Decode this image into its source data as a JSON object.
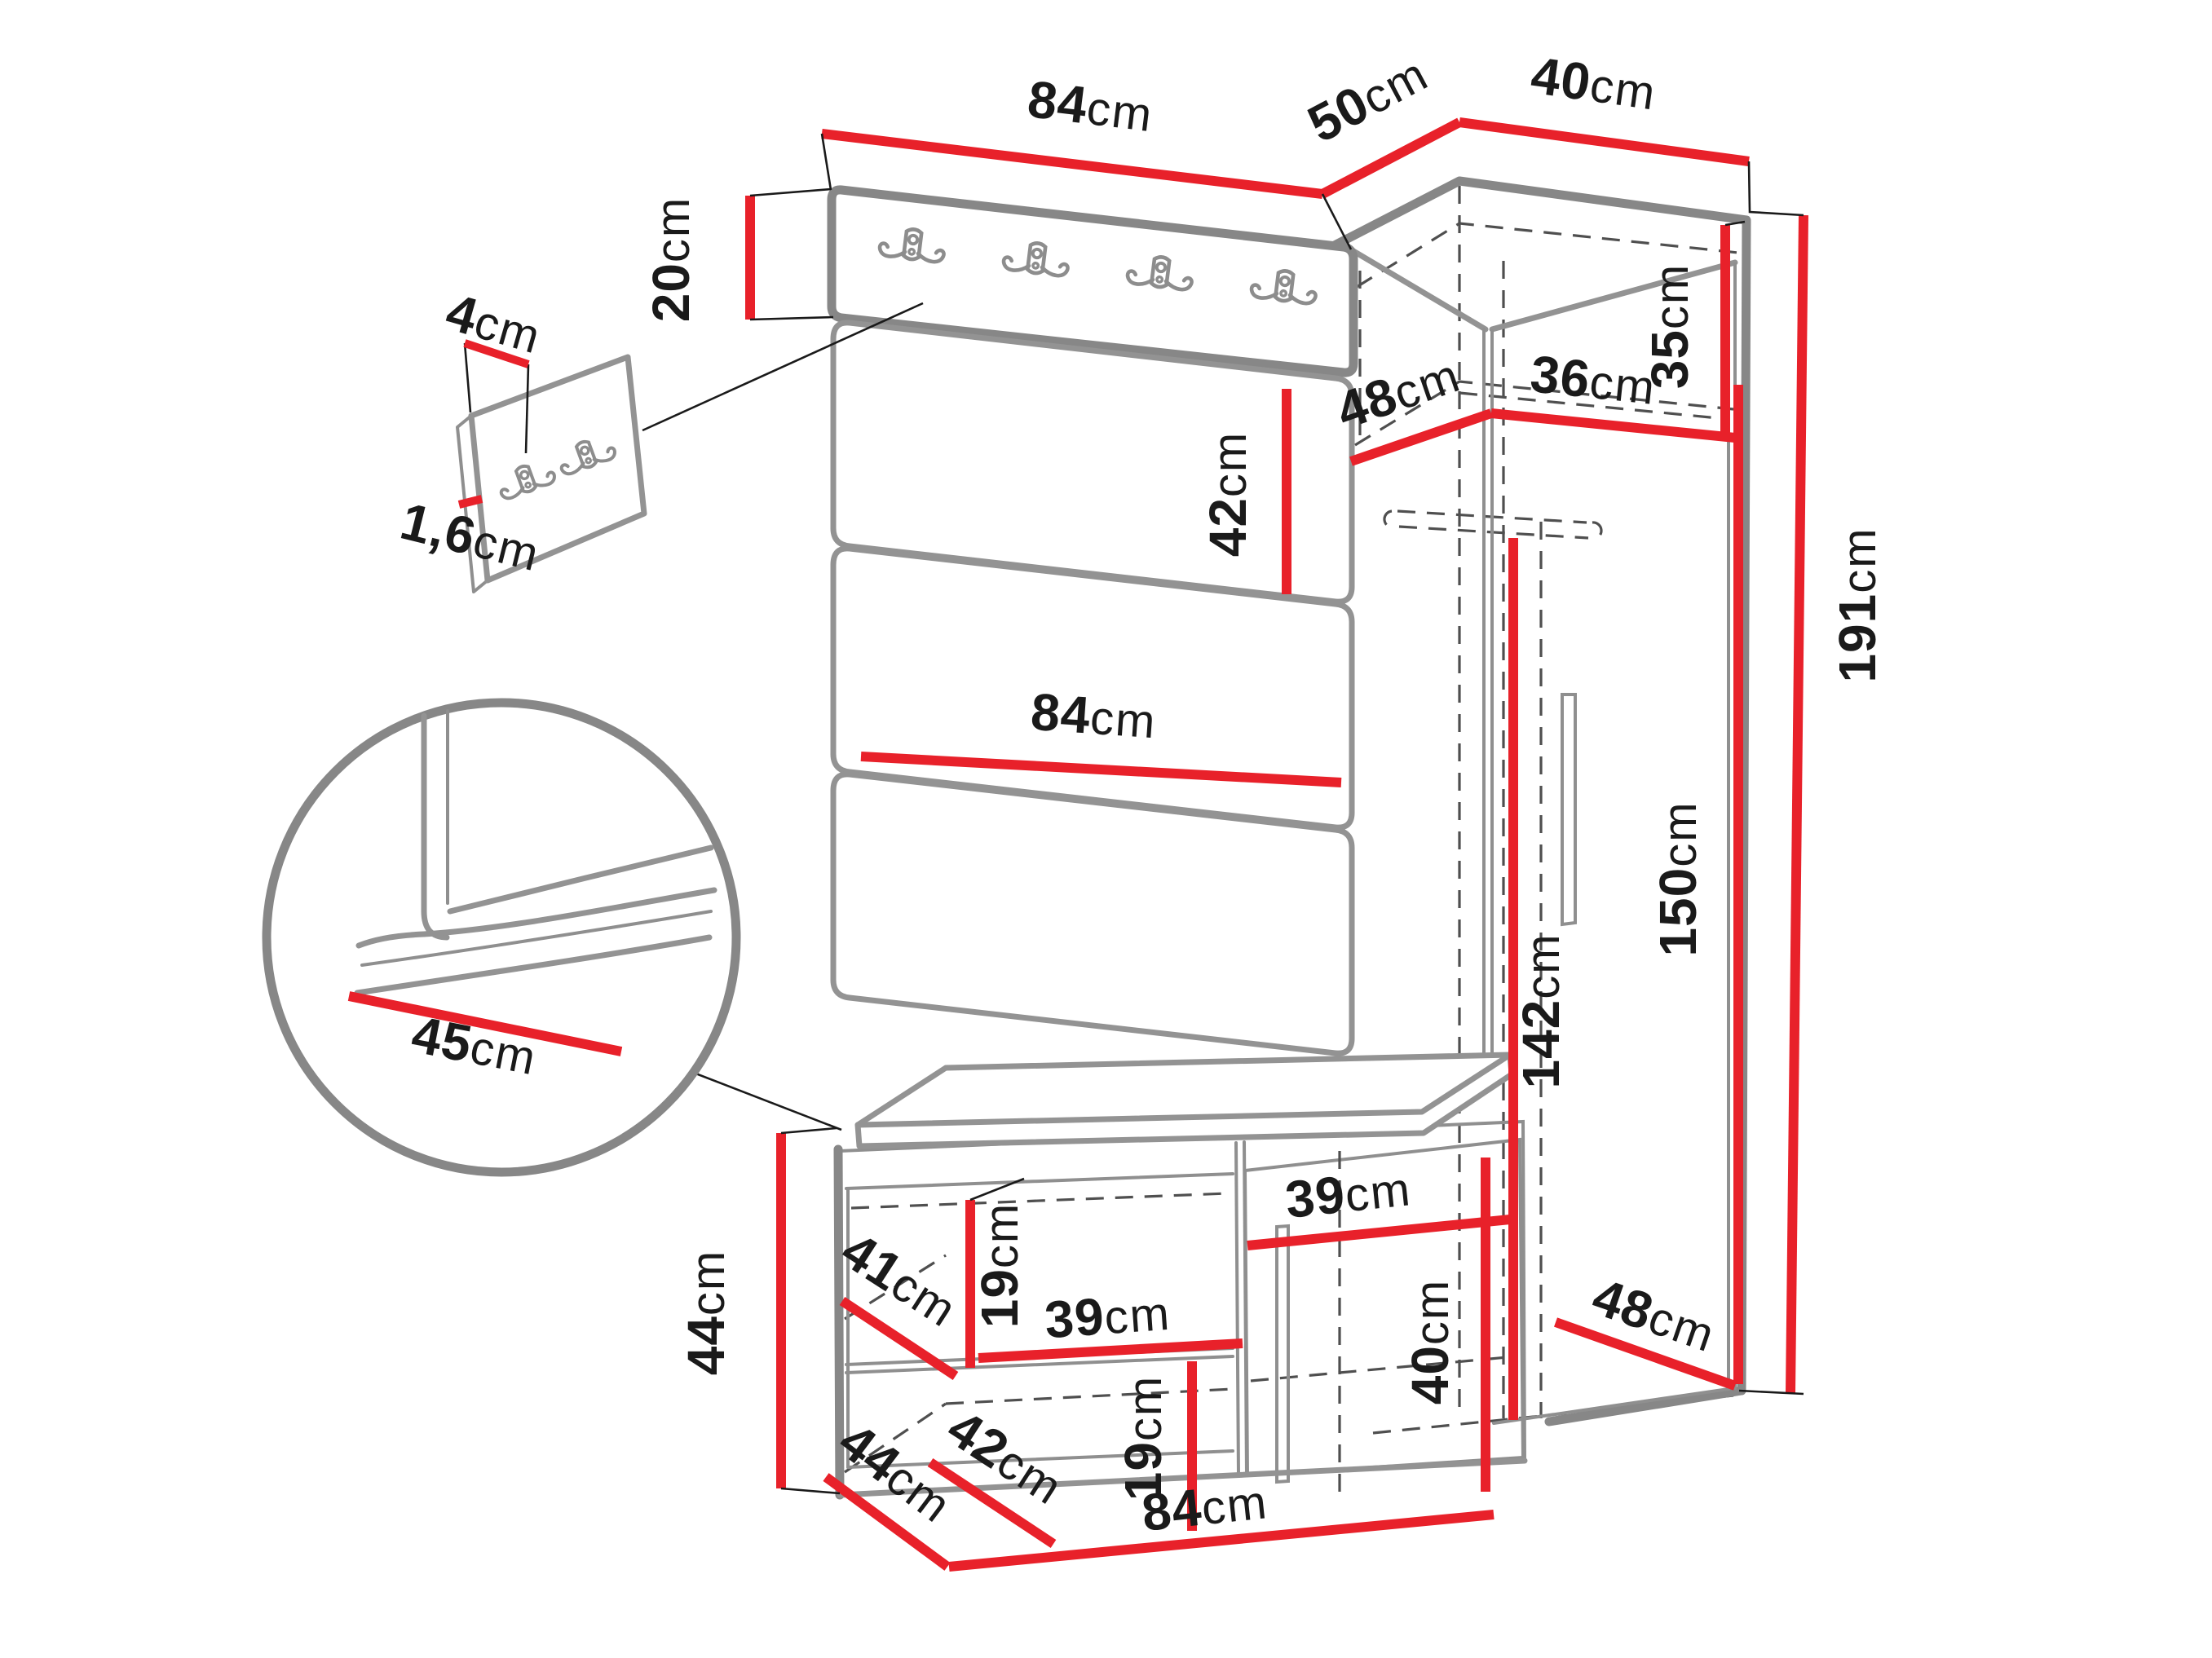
{
  "title": "hallway-furniture-dimension-diagram",
  "colors": {
    "dimension_line": "#e8212a",
    "structure_line": "#878787",
    "hidden_line": "#4f4f4f",
    "label_text": "#1a1a1a",
    "background": "#ffffff"
  },
  "dims": {
    "panel_top_width": {
      "num": "84",
      "unit": "cm"
    },
    "wardrobe_top_left_depth": {
      "num": "50",
      "unit": "cm"
    },
    "wardrobe_top_right_width": {
      "num": "40",
      "unit": "cm"
    },
    "hook_board_height": {
      "num": "20",
      "unit": "cm"
    },
    "detail_width": {
      "num": "4",
      "unit": "cm"
    },
    "detail_thickness": {
      "num": "1,6",
      "unit": "cm"
    },
    "panel_segment_height": {
      "num": "42",
      "unit": "cm"
    },
    "panel_width": {
      "num": "84",
      "unit": "cm"
    },
    "shelf_depth_left": {
      "num": "48",
      "unit": "cm"
    },
    "shelf_width_right": {
      "num": "36",
      "unit": "cm"
    },
    "top_shelf_height": {
      "num": "35",
      "unit": "cm"
    },
    "total_height": {
      "num": "191",
      "unit": "cm"
    },
    "door_height": {
      "num": "150",
      "unit": "cm"
    },
    "hanging_height": {
      "num": "142",
      "unit": "cm"
    },
    "seat_depth": {
      "num": "45",
      "unit": "cm"
    },
    "bench_height": {
      "num": "44",
      "unit": "cm"
    },
    "bench_depth": {
      "num": "41",
      "unit": "cm"
    },
    "bench_shelf_clearance": {
      "num": "19",
      "unit": "cm"
    },
    "bench_shelf_width": {
      "num": "39",
      "unit": "cm"
    },
    "bench_bottom_depth": {
      "num": "42",
      "unit": "cm"
    },
    "bench_lower_clearance": {
      "num": "19",
      "unit": "cm"
    },
    "bench_door_width": {
      "num": "39",
      "unit": "cm"
    },
    "bench_door_height": {
      "num": "40",
      "unit": "cm"
    },
    "wardrobe_bottom_depth": {
      "num": "48",
      "unit": "cm"
    },
    "bench_side_depth": {
      "num": "44",
      "unit": "cm"
    },
    "bench_width": {
      "num": "84",
      "unit": "cm"
    }
  }
}
